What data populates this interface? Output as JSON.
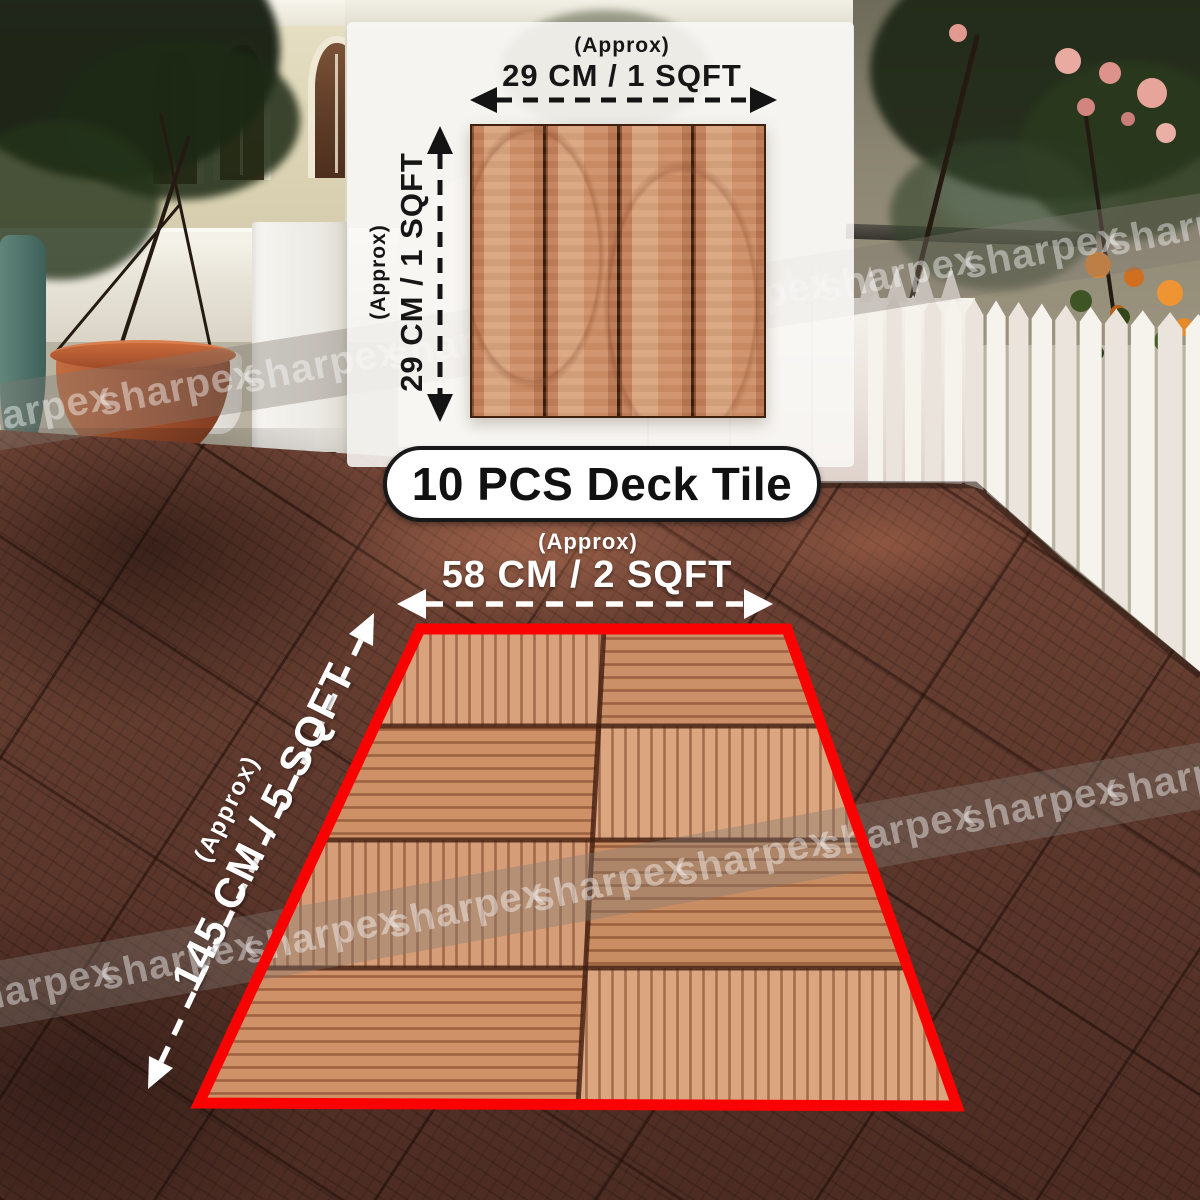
{
  "product_label": {
    "title": "10 PCS Deck Tile"
  },
  "annotations": {
    "tile_width": {
      "approx": "(Approx)",
      "value": "29 CM / 1 SQFT"
    },
    "tile_height": {
      "approx": "(Approx)",
      "value": "29 CM / 1 SQFT"
    },
    "area_width": {
      "approx": "(Approx)",
      "value": "58 CM / 2 SQFT"
    },
    "area_length": {
      "approx": "(Approx)",
      "value": "145 CM / 5 SQFT"
    }
  },
  "watermark": {
    "text": "sharpex"
  },
  "colors": {
    "highlight_red": "#fa0202",
    "annotation_dark": "#161616",
    "annotation_light": "#ffffff",
    "deck_tile_light": "#d29a74",
    "deck_floor_dark": "#573329",
    "fence_white": "#f3efe9"
  }
}
